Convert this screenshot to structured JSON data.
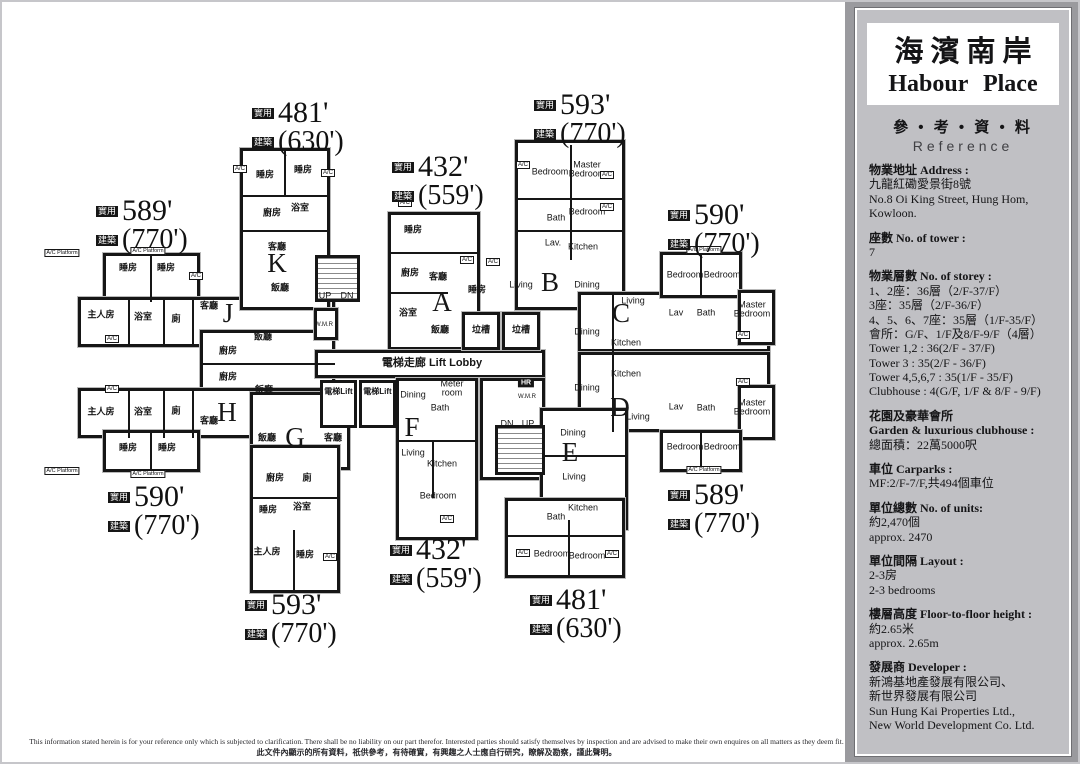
{
  "page": {
    "disclaimer_en": "This information stated herein is for your reference only which is subjected to clarification.  There shall be no liability on our part therefor.  Interested parties should satisfy themselves by inspection and are advised to make their own enquires on all matters as they deem fit.",
    "disclaimer_zh": "此文件內顯示的所有資料，祇供參考，有待確實，有興趣之人士應自行研究，瞭解及勘察，謹此聲明。"
  },
  "sidebar": {
    "title_zh": "海濱南岸",
    "title_en": "Habour Place",
    "ref_zh": "參 • 考 • 資 • 料",
    "ref_en": "Reference",
    "sections": [
      {
        "head": [
          "物業地址  Address :"
        ],
        "body": [
          "九龍紅磡愛景街8號",
          "No.8 Oi King Street, Hung Hom,",
          "Kowloon."
        ]
      },
      {
        "head": [
          "座數  No. of tower :"
        ],
        "body": [
          "7"
        ]
      },
      {
        "head": [
          "物業層數  No. of storey :"
        ],
        "body": [
          "1、2座：36層（2/F-37/F）",
          "3座：35層（2/F-36/F）",
          "4、5、6、7座：35層（1/F-35/F）",
          "會所：G/F、1/F及8/F-9/F（4層）",
          "Tower 1,2 : 36(2/F - 37/F)",
          "Tower 3 : 35(2/F - 36/F)",
          "Tower 4,5,6,7 : 35(1/F - 35/F)",
          "Clubhouse : 4(G/F, 1/F & 8/F - 9/F)"
        ]
      },
      {
        "head": [
          "花園及豪華會所",
          "Garden & luxurious clubhouse :"
        ],
        "body": [
          "總面積：22萬5000呎"
        ]
      },
      {
        "head": [
          "車位  Carparks :"
        ],
        "body": [
          "MF:2/F-7/F,共494個車位"
        ]
      },
      {
        "head": [
          "單位總數  No. of units:"
        ],
        "body": [
          "約2,470個",
          "approx. 2470"
        ]
      },
      {
        "head": [
          "單位間隔  Layout :"
        ],
        "body": [
          "2-3房",
          "2-3 bedrooms"
        ]
      },
      {
        "head": [
          "樓層高度  Floor-to-floor height :"
        ],
        "body": [
          "約2.65米",
          "approx. 2.65m"
        ]
      },
      {
        "head": [
          "發展商  Developer :"
        ],
        "body": [
          "新鴻基地產發展有限公司、",
          "新世界發展有限公司",
          "Sun Hung Kai Properties Ltd.,",
          "New World Development Co. Ltd."
        ]
      }
    ]
  },
  "plan": {
    "prefix_saleable": "實用",
    "prefix_gross": "建築",
    "lift_label": "電梯Lift",
    "ac_label": "A/C",
    "acp_label": "A/C Platform",
    "walls": [
      [
        103,
        253,
        97,
        49
      ],
      [
        78,
        297,
        257,
        50
      ],
      [
        200,
        330,
        135,
        72
      ],
      [
        78,
        388,
        257,
        50
      ],
      [
        103,
        430,
        97,
        42
      ],
      [
        240,
        148,
        90,
        162
      ],
      [
        250,
        392,
        100,
        78
      ],
      [
        250,
        445,
        90,
        148
      ],
      [
        388,
        212,
        92,
        138
      ],
      [
        315,
        350,
        230,
        28
      ],
      [
        396,
        378,
        82,
        162
      ],
      [
        480,
        378,
        65,
        102
      ],
      [
        462,
        312,
        38,
        38
      ],
      [
        502,
        312,
        38,
        38
      ],
      [
        515,
        140,
        110,
        170
      ],
      [
        578,
        292,
        192,
        60
      ],
      [
        660,
        252,
        82,
        46
      ],
      [
        738,
        290,
        37,
        55
      ],
      [
        578,
        352,
        192,
        80
      ],
      [
        738,
        385,
        37,
        55
      ],
      [
        660,
        430,
        82,
        42
      ],
      [
        540,
        408,
        88,
        122
      ],
      [
        505,
        498,
        120,
        80
      ],
      [
        314,
        308,
        24,
        32
      ]
    ],
    "lines": [
      [
        150,
        253,
        2,
        49
      ],
      [
        128,
        300,
        2,
        47
      ],
      [
        163,
        300,
        2,
        47
      ],
      [
        192,
        300,
        2,
        47
      ],
      [
        150,
        430,
        2,
        42
      ],
      [
        128,
        390,
        2,
        48
      ],
      [
        163,
        390,
        2,
        48
      ],
      [
        192,
        390,
        2,
        48
      ],
      [
        284,
        148,
        2,
        47
      ],
      [
        240,
        195,
        90,
        2
      ],
      [
        240,
        230,
        90,
        2
      ],
      [
        388,
        252,
        92,
        2
      ],
      [
        388,
        292,
        60,
        2
      ],
      [
        570,
        145,
        2,
        115
      ],
      [
        518,
        198,
        107,
        2
      ],
      [
        518,
        230,
        107,
        2
      ],
      [
        700,
        252,
        2,
        46
      ],
      [
        700,
        430,
        2,
        42
      ],
      [
        612,
        292,
        2,
        60
      ],
      [
        612,
        352,
        2,
        80
      ],
      [
        540,
        455,
        88,
        2
      ],
      [
        568,
        520,
        2,
        58
      ],
      [
        505,
        535,
        120,
        2
      ],
      [
        396,
        440,
        82,
        2
      ],
      [
        432,
        440,
        2,
        58
      ],
      [
        250,
        497,
        90,
        2
      ],
      [
        293,
        530,
        2,
        63
      ],
      [
        200,
        363,
        135,
        2
      ]
    ],
    "stairs": [
      [
        315,
        255,
        45,
        47
      ],
      [
        495,
        425,
        50,
        50
      ]
    ],
    "lifts": [
      [
        320,
        380,
        37,
        48
      ],
      [
        359,
        380,
        37,
        48
      ]
    ],
    "units": [
      [
        277,
        263,
        "K"
      ],
      [
        228,
        313,
        "J"
      ],
      [
        227,
        412,
        "H"
      ],
      [
        295,
        437,
        "G"
      ],
      [
        442,
        302,
        "A"
      ],
      [
        550,
        282,
        "B"
      ],
      [
        621,
        313,
        "C"
      ],
      [
        620,
        407,
        "D"
      ],
      [
        570,
        452,
        "E"
      ],
      [
        412,
        427,
        "F"
      ]
    ],
    "areas": [
      [
        96,
        196,
        "589'",
        "(770')"
      ],
      [
        252,
        98,
        "481'",
        "(630')"
      ],
      [
        392,
        152,
        "432'",
        "(559')"
      ],
      [
        534,
        90,
        "593'",
        "(770')"
      ],
      [
        668,
        200,
        "590'",
        "(770')"
      ],
      [
        668,
        480,
        "589'",
        "(770')"
      ],
      [
        530,
        585,
        "481'",
        "(630')"
      ],
      [
        390,
        535,
        "432'",
        "(559')"
      ],
      [
        245,
        590,
        "593'",
        "(770')"
      ],
      [
        108,
        482,
        "590'",
        "(770')"
      ]
    ],
    "labels": [
      [
        128,
        268,
        "睡房",
        "zh"
      ],
      [
        166,
        268,
        "睡房",
        "zh"
      ],
      [
        101,
        315,
        "主人房",
        "zh"
      ],
      [
        143,
        317,
        "浴室",
        "zh"
      ],
      [
        176,
        319,
        "廁",
        "zh"
      ],
      [
        209,
        306,
        "客廳",
        "zh"
      ],
      [
        263,
        337,
        "飯廳",
        "zh"
      ],
      [
        228,
        351,
        "廚房",
        "zh"
      ],
      [
        228,
        377,
        "廚房",
        "zh"
      ],
      [
        264,
        390,
        "飯廳",
        "zh"
      ],
      [
        101,
        412,
        "主人房",
        "zh"
      ],
      [
        143,
        412,
        "浴室",
        "zh"
      ],
      [
        176,
        411,
        "廁",
        "zh"
      ],
      [
        209,
        421,
        "客廳",
        "zh"
      ],
      [
        128,
        448,
        "睡房",
        "zh"
      ],
      [
        167,
        448,
        "睡房",
        "zh"
      ],
      [
        265,
        175,
        "睡房",
        "zh"
      ],
      [
        303,
        170,
        "睡房",
        "zh"
      ],
      [
        272,
        213,
        "廚房",
        "zh"
      ],
      [
        300,
        208,
        "浴室",
        "zh"
      ],
      [
        277,
        247,
        "客廳",
        "zh"
      ],
      [
        280,
        288,
        "飯廳",
        "zh"
      ],
      [
        413,
        230,
        "睡房",
        "zh"
      ],
      [
        410,
        273,
        "廚房",
        "zh"
      ],
      [
        438,
        277,
        "客廳",
        "zh"
      ],
      [
        408,
        313,
        "浴室",
        "zh"
      ],
      [
        440,
        330,
        "飯廳",
        "zh"
      ],
      [
        477,
        290,
        "睡房",
        "zh"
      ],
      [
        267,
        438,
        "飯廳",
        "zh"
      ],
      [
        333,
        438,
        "客廳",
        "zh"
      ],
      [
        275,
        478,
        "廚房",
        "zh"
      ],
      [
        307,
        478,
        "廁",
        "zh"
      ],
      [
        302,
        507,
        "浴室",
        "zh"
      ],
      [
        268,
        510,
        "睡房",
        "zh"
      ],
      [
        267,
        552,
        "主人房",
        "zh"
      ],
      [
        305,
        555,
        "睡房",
        "zh"
      ],
      [
        481,
        330,
        "垃槽",
        "zh"
      ],
      [
        521,
        330,
        "垃槽",
        "zh"
      ],
      [
        432,
        364,
        "電梯走廊 Lift Lobby",
        "lobby"
      ],
      [
        550,
        172,
        "Bedroom",
        "en"
      ],
      [
        587,
        170,
        "Master\nBedroom",
        "en"
      ],
      [
        556,
        218,
        "Bath",
        "en"
      ],
      [
        553,
        243,
        "Lav.",
        "en"
      ],
      [
        587,
        212,
        "Bedroom",
        "en"
      ],
      [
        583,
        247,
        "Kitchen",
        "en"
      ],
      [
        521,
        285,
        "Living",
        "en"
      ],
      [
        587,
        285,
        "Dining",
        "en"
      ],
      [
        633,
        301,
        "Living",
        "en"
      ],
      [
        587,
        332,
        "Dining",
        "en"
      ],
      [
        626,
        343,
        "Kitchen",
        "en"
      ],
      [
        685,
        275,
        "Bedroom",
        "en"
      ],
      [
        722,
        275,
        "Bedroom",
        "en"
      ],
      [
        676,
        313,
        "Lav",
        "en"
      ],
      [
        706,
        313,
        "Bath",
        "en"
      ],
      [
        752,
        310,
        "Master\nBedroom",
        "en"
      ],
      [
        626,
        374,
        "Kitchen",
        "en"
      ],
      [
        587,
        388,
        "Dining",
        "en"
      ],
      [
        638,
        417,
        "Living",
        "en"
      ],
      [
        676,
        407,
        "Lav",
        "en"
      ],
      [
        706,
        408,
        "Bath",
        "en"
      ],
      [
        752,
        408,
        "Master\nBedroom",
        "en"
      ],
      [
        685,
        447,
        "Bedroom",
        "en"
      ],
      [
        722,
        447,
        "Bedroom",
        "en"
      ],
      [
        573,
        433,
        "Dining",
        "en"
      ],
      [
        574,
        477,
        "Living",
        "en"
      ],
      [
        556,
        517,
        "Bath",
        "en"
      ],
      [
        583,
        508,
        "Kitchen",
        "en"
      ],
      [
        552,
        554,
        "Bedroom",
        "en"
      ],
      [
        587,
        556,
        "Bedroom",
        "en"
      ],
      [
        413,
        395,
        "Dining",
        "en"
      ],
      [
        413,
        453,
        "Living",
        "en"
      ],
      [
        442,
        464,
        "Kitchen",
        "en"
      ],
      [
        438,
        496,
        "Bedroom",
        "en"
      ],
      [
        452,
        389,
        "Meter\nroom",
        "en"
      ],
      [
        440,
        408,
        "Bath",
        "en"
      ],
      [
        325,
        296,
        "UP",
        "en"
      ],
      [
        347,
        296,
        "DN",
        "en"
      ],
      [
        507,
        424,
        "DN",
        "en"
      ],
      [
        528,
        424,
        "UP",
        "en"
      ],
      [
        526,
        383,
        "HR",
        "hrbox"
      ],
      [
        527,
        397,
        "W.M.R",
        "xs"
      ],
      [
        324,
        325,
        "W.M.R",
        "xs"
      ]
    ],
    "ac": [
      [
        112,
        339
      ],
      [
        112,
        389
      ],
      [
        196,
        276
      ],
      [
        240,
        169
      ],
      [
        328,
        173
      ],
      [
        405,
        203
      ],
      [
        467,
        260
      ],
      [
        493,
        262
      ],
      [
        523,
        165
      ],
      [
        607,
        175
      ],
      [
        607,
        207
      ],
      [
        743,
        335
      ],
      [
        743,
        382
      ],
      [
        523,
        553
      ],
      [
        612,
        554
      ],
      [
        447,
        519
      ],
      [
        330,
        557
      ]
    ],
    "acp": [
      [
        148,
        251
      ],
      [
        148,
        474
      ],
      [
        704,
        250
      ],
      [
        704,
        470
      ],
      [
        62,
        253
      ],
      [
        62,
        471
      ]
    ]
  }
}
